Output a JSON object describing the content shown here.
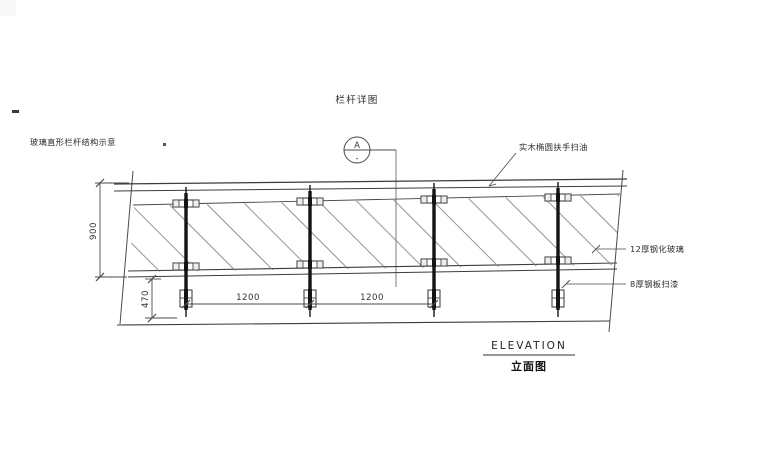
{
  "page": {
    "title": "栏杆详图",
    "left_note": "玻璃直形栏杆结构示意"
  },
  "section_marker": {
    "letter": "A",
    "number": "-"
  },
  "dimensions": {
    "height": "900",
    "post_embed": "470",
    "spacing_1": "1200",
    "spacing_2": "1200"
  },
  "annotations": {
    "handrail": "实木椭圆扶手扫油",
    "glass": "12厚钢化玻璃",
    "post_plate": "8厚钢板扫漆"
  },
  "footer": {
    "title": "ELEVATION",
    "subtitle": "立面图"
  },
  "colors": {
    "line": "#3c3c3c",
    "post": "#141414",
    "hatch": "#787878",
    "text": "#2b2b2b",
    "background": "#ffffff"
  }
}
